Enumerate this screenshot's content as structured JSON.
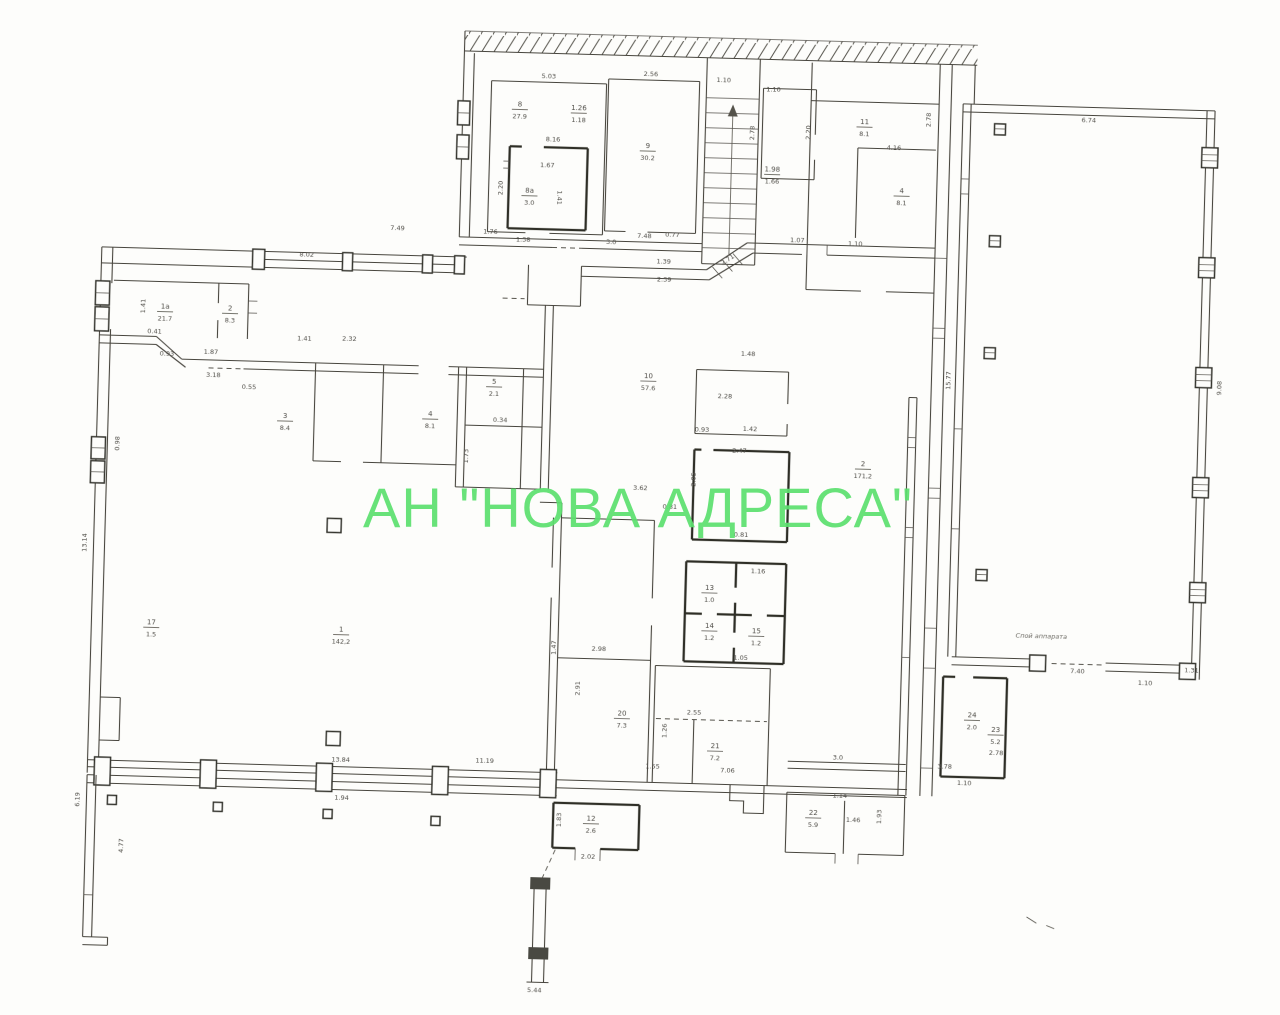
{
  "watermark": {
    "text": "АН \"НОВА АДРЕСА\"",
    "color": "#5ce06f"
  },
  "colors": {
    "paper": "#fdfdfb",
    "ink": "#46443e",
    "ink_bold": "#2f2d28",
    "watermark_green": "#5ce06f"
  },
  "plan": {
    "type": "scanned floor plan",
    "party_wall": "hatched wall band along top edge",
    "staircase": "single flight, top centre",
    "note_label": {
      "x": 1045,
      "y": 627,
      "t": "Спой аппарата"
    }
  },
  "dim_labels": [
    {
      "x": 537,
      "y": 81,
      "t": "5.03"
    },
    {
      "x": 639,
      "y": 76,
      "t": "2.56"
    },
    {
      "x": 712,
      "y": 80,
      "t": "1.10"
    },
    {
      "x": 762,
      "y": 88,
      "t": "1.10"
    },
    {
      "x": 543,
      "y": 144,
      "t": "8.16"
    },
    {
      "x": 538,
      "y": 170,
      "t": "1.67"
    },
    {
      "x": 549,
      "y": 200,
      "t": "1.41",
      "r": 90
    },
    {
      "x": 494,
      "y": 192,
      "t": "2.20",
      "r": -90
    },
    {
      "x": 483,
      "y": 238,
      "t": "1.76"
    },
    {
      "x": 516,
      "y": 245,
      "t": "1.38"
    },
    {
      "x": 604,
      "y": 245,
      "t": "3.0"
    },
    {
      "x": 637,
      "y": 238,
      "t": "7.48"
    },
    {
      "x": 665,
      "y": 236,
      "t": "0.77"
    },
    {
      "x": 744,
      "y": 130,
      "t": "2.78",
      "r": -90
    },
    {
      "x": 800,
      "y": 128,
      "t": "2.20",
      "r": -90
    },
    {
      "x": 884,
      "y": 143,
      "t": "4.16"
    },
    {
      "x": 920,
      "y": 112,
      "t": "2.78",
      "r": -90
    },
    {
      "x": 848,
      "y": 240,
      "t": "1.10"
    },
    {
      "x": 1078,
      "y": 110,
      "t": "6.74"
    },
    {
      "x": 947,
      "y": 372,
      "t": "15.77",
      "r": -90
    },
    {
      "x": 1218,
      "y": 372,
      "t": "9.08",
      "r": -90
    },
    {
      "x": 1082,
      "y": 661,
      "t": "7.40"
    },
    {
      "x": 1150,
      "y": 671,
      "t": "1.10"
    },
    {
      "x": 1196,
      "y": 657,
      "t": "1.31"
    },
    {
      "x": 657,
      "y": 263,
      "t": "1.39"
    },
    {
      "x": 658,
      "y": 281,
      "t": "2.39"
    },
    {
      "x": 722,
      "y": 259,
      "t": "2.71",
      "r": -35
    },
    {
      "x": 790,
      "y": 238,
      "t": "1.07"
    },
    {
      "x": 300,
      "y": 266,
      "t": "8.02"
    },
    {
      "x": 390,
      "y": 237,
      "t": "7.49"
    },
    {
      "x": 140,
      "y": 320,
      "t": "1.41",
      "r": -90
    },
    {
      "x": 150,
      "y": 347,
      "t": "0.41"
    },
    {
      "x": 163,
      "y": 369,
      "t": "0.93"
    },
    {
      "x": 207,
      "y": 366,
      "t": "1.87"
    },
    {
      "x": 210,
      "y": 389,
      "t": "3.18"
    },
    {
      "x": 246,
      "y": 400,
      "t": "0.55"
    },
    {
      "x": 300,
      "y": 350,
      "t": "1.41"
    },
    {
      "x": 345,
      "y": 349,
      "t": "2.32"
    },
    {
      "x": 498,
      "y": 426,
      "t": "0.34"
    },
    {
      "x": 467,
      "y": 461,
      "t": "1.73",
      "r": -90
    },
    {
      "x": 118,
      "y": 458,
      "t": "0.98",
      "r": -90
    },
    {
      "x": 88,
      "y": 558,
      "t": "13.14",
      "r": -90
    },
    {
      "x": 88,
      "y": 815,
      "t": "6.19",
      "r": -90
    },
    {
      "x": 133,
      "y": 860,
      "t": "4.77",
      "r": -90
    },
    {
      "x": 738,
      "y": 450,
      "t": "2.47"
    },
    {
      "x": 742,
      "y": 534,
      "t": "0.81"
    },
    {
      "x": 760,
      "y": 570,
      "t": "1.16"
    },
    {
      "x": 745,
      "y": 657,
      "t": "1.05"
    },
    {
      "x": 700,
      "y": 430,
      "t": "0.93"
    },
    {
      "x": 748,
      "y": 428,
      "t": "1.42"
    },
    {
      "x": 744,
      "y": 353,
      "t": "1.48"
    },
    {
      "x": 722,
      "y": 396,
      "t": "2.28"
    },
    {
      "x": 695,
      "y": 478,
      "t": "2.05",
      "r": -90
    },
    {
      "x": 640,
      "y": 490,
      "t": "3.62"
    },
    {
      "x": 670,
      "y": 508,
      "t": "0.81"
    },
    {
      "x": 603,
      "y": 652,
      "t": "2.98"
    },
    {
      "x": 560,
      "y": 650,
      "t": "1.47",
      "r": -90
    },
    {
      "x": 585,
      "y": 690,
      "t": "2.91",
      "r": -90
    },
    {
      "x": 673,
      "y": 730,
      "t": "1.26",
      "r": -90
    },
    {
      "x": 700,
      "y": 713,
      "t": "2.55"
    },
    {
      "x": 735,
      "y": 770,
      "t": "7.06"
    },
    {
      "x": 660,
      "y": 768,
      "t": "1.55"
    },
    {
      "x": 845,
      "y": 754,
      "t": "3.0"
    },
    {
      "x": 848,
      "y": 792,
      "t": "1.14"
    },
    {
      "x": 862,
      "y": 816,
      "t": "1.46"
    },
    {
      "x": 890,
      "y": 810,
      "t": "1.93",
      "r": -90
    },
    {
      "x": 348,
      "y": 770,
      "t": "13.84"
    },
    {
      "x": 492,
      "y": 767,
      "t": "11.19"
    },
    {
      "x": 350,
      "y": 808,
      "t": "1.94"
    },
    {
      "x": 972,
      "y": 776,
      "t": "1.10"
    },
    {
      "x": 952,
      "y": 760,
      "t": "3.78"
    },
    {
      "x": 1003,
      "y": 745,
      "t": "2.78"
    },
    {
      "x": 548,
      "y": 995,
      "t": "5.44"
    },
    {
      "x": 598,
      "y": 860,
      "t": "2.02"
    },
    {
      "x": 570,
      "y": 822,
      "t": "1.83",
      "r": -90
    }
  ],
  "room_labels": [
    {
      "x": 509,
      "y": 110,
      "n": "8",
      "a": "27.9"
    },
    {
      "x": 638,
      "y": 148,
      "n": "9",
      "a": "30.2"
    },
    {
      "x": 568,
      "y": 112,
      "n": "1.26",
      "a": "1.18"
    },
    {
      "x": 893,
      "y": 186,
      "n": "4",
      "a": "8.1"
    },
    {
      "x": 763,
      "y": 168,
      "n": "1.98",
      "a": "1.66"
    },
    {
      "x": 854,
      "y": 118,
      "n": "11",
      "a": "8.1"
    },
    {
      "x": 160,
      "y": 322,
      "n": "1а",
      "a": "21.7"
    },
    {
      "x": 225,
      "y": 322,
      "n": "2",
      "a": "8.3"
    },
    {
      "x": 283,
      "y": 428,
      "n": "3",
      "a": "8.4"
    },
    {
      "x": 428,
      "y": 422,
      "n": "4",
      "a": "8.1"
    },
    {
      "x": 491,
      "y": 388,
      "n": "5",
      "a": "2.1"
    },
    {
      "x": 521,
      "y": 196,
      "n": "8а",
      "a": "3.0"
    },
    {
      "x": 645,
      "y": 378,
      "n": "10",
      "a": "57.6"
    },
    {
      "x": 862,
      "y": 460,
      "n": "2",
      "a": "171,2"
    },
    {
      "x": 155,
      "y": 638,
      "n": "17",
      "a": "1.5"
    },
    {
      "x": 345,
      "y": 640,
      "n": "1",
      "a": "142,2"
    },
    {
      "x": 628,
      "y": 716,
      "n": "20",
      "a": "7.3"
    },
    {
      "x": 722,
      "y": 746,
      "n": "21",
      "a": "7.2"
    },
    {
      "x": 822,
      "y": 810,
      "n": "22",
      "a": "5.9"
    },
    {
      "x": 712,
      "y": 588,
      "n": "13",
      "a": "1.0"
    },
    {
      "x": 713,
      "y": 626,
      "n": "14",
      "a": "1.2"
    },
    {
      "x": 760,
      "y": 630,
      "n": "15",
      "a": "1.2"
    },
    {
      "x": 978,
      "y": 708,
      "n": "24",
      "a": "2.0"
    },
    {
      "x": 1002,
      "y": 722,
      "n": "23",
      "a": "5.2"
    },
    {
      "x": 600,
      "y": 822,
      "n": "12",
      "a": "2.6"
    }
  ]
}
